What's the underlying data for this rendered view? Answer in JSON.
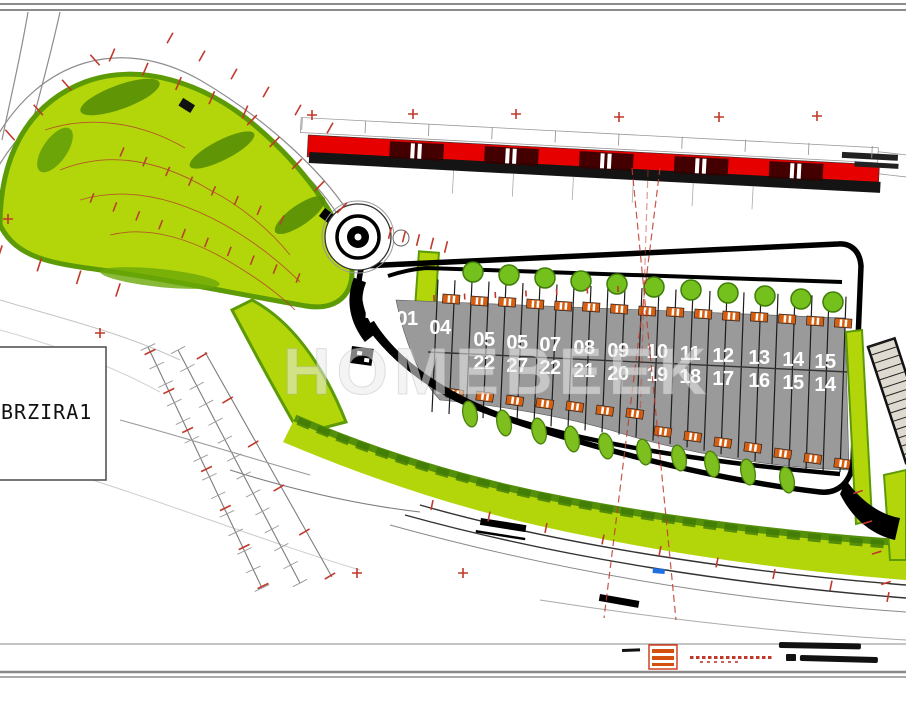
{
  "site_label": {
    "text": "BRZIRA1"
  },
  "watermark": {
    "text": "HOMEBEEK"
  },
  "colors": {
    "lime": "#b2d60a",
    "dark_green": "#568e04",
    "tree_green": "#74c01d",
    "plot_gray": "#9a9a9a",
    "strip_red": "#e60000",
    "roof_orange": "#d95f10",
    "mark_red": "#c0392b",
    "contour_rust": "#b5442a",
    "road_gray": "#888888",
    "blue_mark": "#1f6fe0"
  },
  "plots": [
    {
      "top": "01",
      "bottom": "",
      "x": 407,
      "y": 325
    },
    {
      "top": "04",
      "bottom": "",
      "x": 440,
      "y": 334
    },
    {
      "top": "05",
      "bottom": "22",
      "x": 484,
      "y": 346
    },
    {
      "top": "05",
      "bottom": "27",
      "x": 517,
      "y": 349
    },
    {
      "top": "07",
      "bottom": "22",
      "x": 550,
      "y": 351
    },
    {
      "top": "08",
      "bottom": "21",
      "x": 584,
      "y": 354
    },
    {
      "top": "09",
      "bottom": "20",
      "x": 618,
      "y": 357
    },
    {
      "top": "10",
      "bottom": "19",
      "x": 657,
      "y": 358
    },
    {
      "top": "11",
      "bottom": "18",
      "x": 690,
      "y": 360
    },
    {
      "top": "12",
      "bottom": "17",
      "x": 723,
      "y": 362
    },
    {
      "top": "13",
      "bottom": "16",
      "x": 759,
      "y": 364
    },
    {
      "top": "14",
      "bottom": "15",
      "x": 793,
      "y": 366
    },
    {
      "top": "15",
      "bottom": "14",
      "x": 825,
      "y": 368
    }
  ],
  "trees": {
    "top": [
      [
        473,
        272
      ],
      [
        509,
        275
      ],
      [
        545,
        278
      ],
      [
        581,
        281
      ],
      [
        617,
        284
      ],
      [
        654,
        287
      ],
      [
        691,
        290
      ],
      [
        728,
        293
      ],
      [
        765,
        296
      ],
      [
        801,
        299
      ],
      [
        833,
        302
      ]
    ],
    "bottom": [
      [
        470,
        414
      ],
      [
        504,
        423
      ],
      [
        539,
        431
      ],
      [
        572,
        439
      ],
      [
        606,
        446
      ],
      [
        644,
        452
      ],
      [
        679,
        458
      ],
      [
        712,
        464
      ],
      [
        748,
        472
      ],
      [
        787,
        480
      ]
    ]
  },
  "roofs": {
    "top": [
      [
        443,
        294
      ],
      [
        471,
        296
      ],
      [
        499,
        297
      ],
      [
        527,
        299
      ],
      [
        555,
        301
      ],
      [
        583,
        302
      ],
      [
        611,
        304
      ],
      [
        639,
        306
      ],
      [
        667,
        307
      ],
      [
        695,
        309
      ],
      [
        723,
        311
      ],
      [
        751,
        312
      ],
      [
        779,
        314
      ],
      [
        807,
        316
      ],
      [
        835,
        318
      ]
    ],
    "bottom": [
      [
        447,
        388
      ],
      [
        477,
        391
      ],
      [
        507,
        395
      ],
      [
        537,
        398
      ],
      [
        567,
        401
      ],
      [
        597,
        405
      ],
      [
        627,
        408
      ],
      [
        655,
        426
      ],
      [
        685,
        431
      ],
      [
        715,
        437
      ],
      [
        745,
        442
      ],
      [
        775,
        448
      ],
      [
        805,
        453
      ],
      [
        835,
        458
      ]
    ]
  },
  "survey_crosses": [
    [
      312,
      115
    ],
    [
      413,
      114
    ],
    [
      516,
      114
    ],
    [
      619,
      117
    ],
    [
      719,
      117
    ],
    [
      817,
      116
    ],
    [
      100,
      333
    ],
    [
      8,
      219
    ],
    [
      357,
      573
    ],
    [
      463,
      573
    ]
  ],
  "tick_lines": [
    {
      "p": [
        10,
        135,
        95,
        60
      ],
      "n": 4,
      "len": 7,
      "c": "red"
    },
    {
      "p": [
        112,
        55,
        245,
        112
      ],
      "n": 5,
      "len": 7,
      "c": "red"
    },
    {
      "p": [
        252,
        120,
        342,
        208
      ],
      "n": 5,
      "len": 7,
      "c": "red"
    },
    {
      "p": [
        170,
        38,
        330,
        128
      ],
      "n": 6,
      "len": 6,
      "c": "red"
    },
    {
      "p": [
        0,
        252,
        118,
        290
      ],
      "n": 4,
      "len": 7,
      "c": "red"
    },
    {
      "p": [
        150,
        352,
        263,
        586
      ],
      "n": 7,
      "len": 6,
      "c": "red"
    },
    {
      "p": [
        202,
        356,
        330,
        576
      ],
      "n": 6,
      "len": 6,
      "c": "red"
    },
    {
      "p": [
        432,
        505,
        888,
        597
      ],
      "n": 9,
      "len": 5,
      "c": "red"
    },
    {
      "p": [
        434,
        298,
        618,
        289
      ],
      "n": 7,
      "len": 3,
      "c": "red"
    },
    {
      "p": [
        858,
        492,
        886,
        583
      ],
      "n": 4,
      "len": 5,
      "c": "red"
    },
    {
      "p": [
        390,
        233,
        446,
        247
      ],
      "n": 5,
      "len": 6,
      "c": "red"
    },
    {
      "p": [
        148,
        347,
        262,
        588
      ],
      "n": 14,
      "len": 8,
      "c": "gray"
    },
    {
      "p": [
        178,
        350,
        300,
        583
      ],
      "n": 14,
      "len": 8,
      "c": "gray"
    },
    {
      "p": [
        302,
        124,
        872,
        152
      ],
      "n": 10,
      "len": 6,
      "c": "gray"
    },
    {
      "p": [
        92,
        198,
        298,
        278
      ],
      "n": 10,
      "len": 5,
      "c": "rust"
    },
    {
      "p": [
        122,
        152,
        282,
        220
      ],
      "n": 8,
      "len": 5,
      "c": "rust"
    }
  ],
  "legend": {
    "swatch_icon": "red-striped-building-swatch",
    "red_caption_illegible": true,
    "scale_bars_illegible": true
  }
}
